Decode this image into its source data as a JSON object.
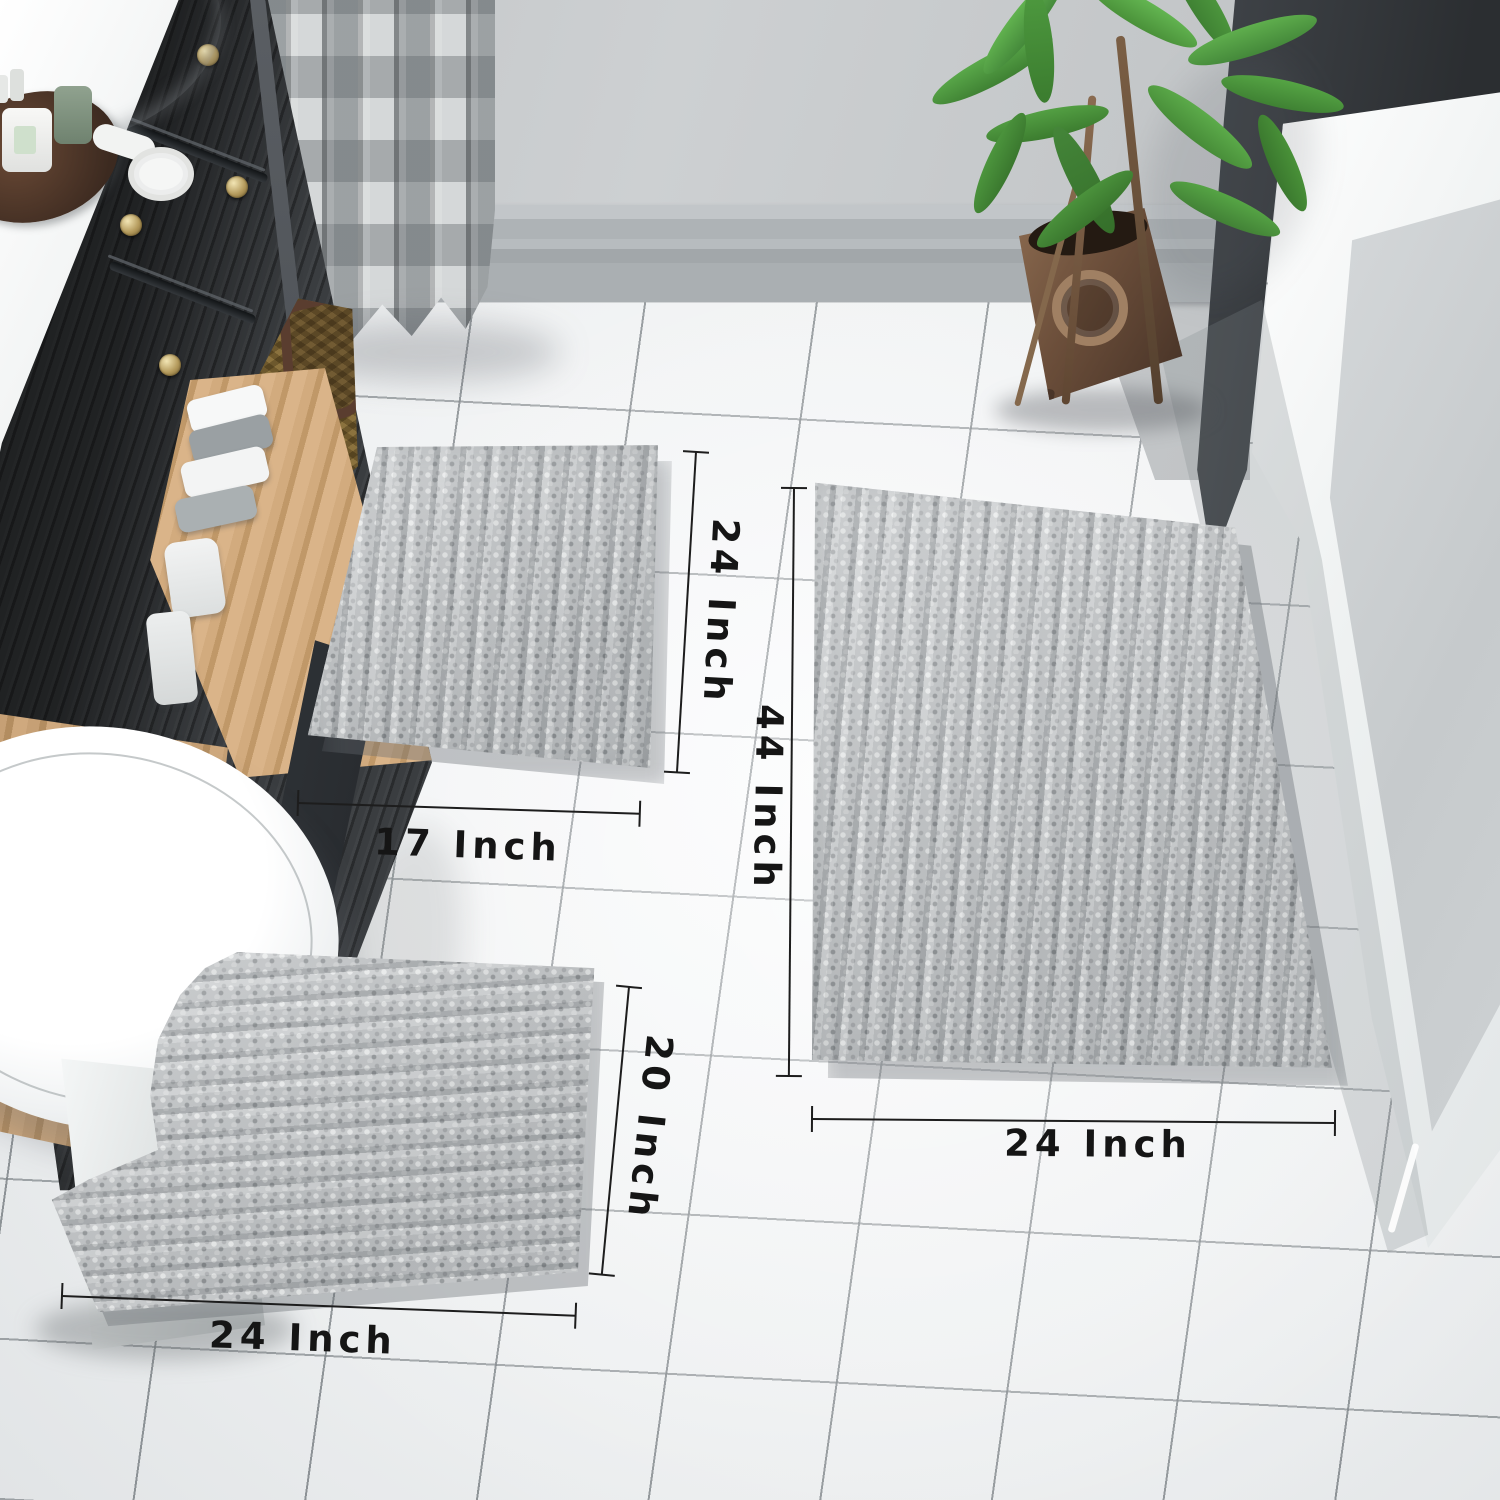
{
  "dimensions": [
    {
      "id": "small-rug-height",
      "label": "24 Inch"
    },
    {
      "id": "small-rug-width",
      "label": "17 Inch"
    },
    {
      "id": "large-rug-height",
      "label": "44 Inch"
    },
    {
      "id": "large-rug-width",
      "label": "24 Inch"
    },
    {
      "id": "contour-rug-height",
      "label": "20 Inch"
    },
    {
      "id": "contour-rug-width",
      "label": "24 Inch"
    }
  ],
  "scene_objects": [
    "bathroom-vanity",
    "sink",
    "toiletries-tray",
    "shower-curtain",
    "laundry-basket",
    "wall-baseboard",
    "potted-plant",
    "bathtub",
    "glass-panel",
    "toilet",
    "small-bath-rug",
    "large-bath-rug",
    "contour-bath-rug",
    "tile-floor"
  ],
  "palette": {
    "rug_gray": "#c5c8ca",
    "floor": "#f0f1f2",
    "grout": "#7d8387",
    "wall": "#c7cacc",
    "dark_panel": "#33373a",
    "vanity": "#34373a",
    "wood": "#c8a876",
    "curtain_dark": "#8e9397",
    "curtain_light": "#d6d9da",
    "tub_white": "#f4f6f6",
    "plant_green": "#4f9c3e",
    "pot_bronze": "#6b4e3a",
    "annotation": "#1d1d1d"
  }
}
